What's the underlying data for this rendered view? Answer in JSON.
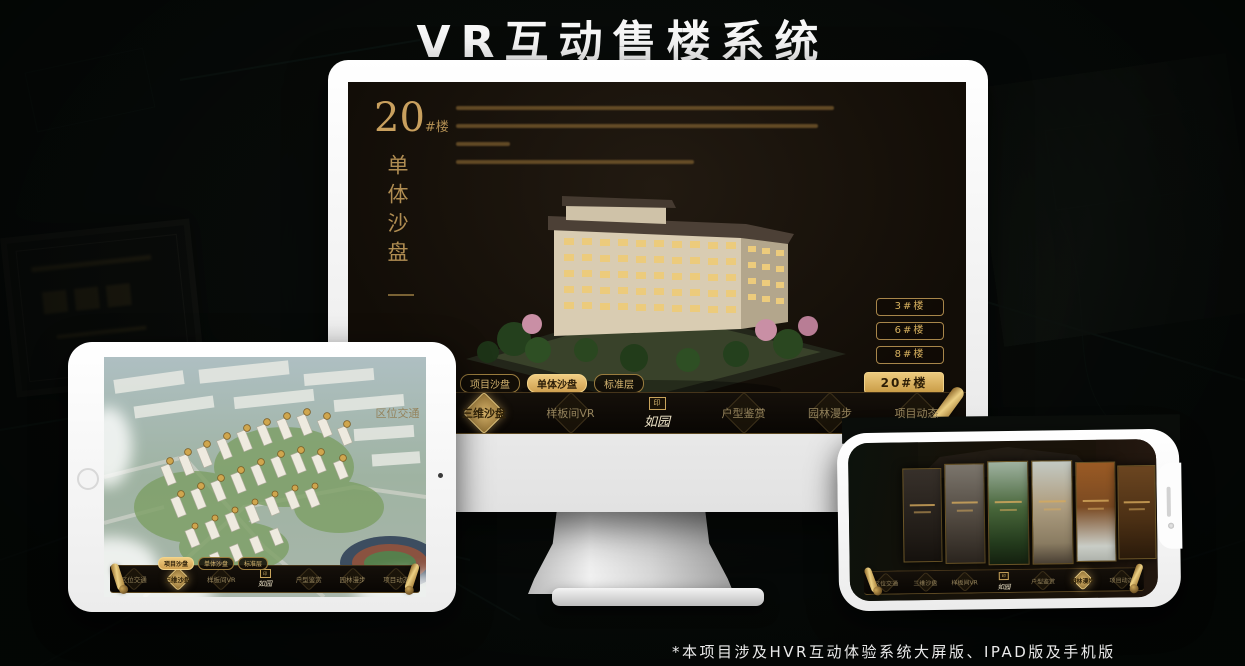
{
  "page": {
    "title": "VR互动售楼系统",
    "footnote": "*本项目涉及HVR互动体验系统大屏版、IPAD版及手机版"
  },
  "colors": {
    "gold": "#c9a05e",
    "gold_bright": "#ecca7e",
    "screen_bg": "#17110b",
    "title_white": "#f7f7f7"
  },
  "app": {
    "logo": "如园",
    "logo_seal": "印",
    "nav_items": [
      {
        "label": "区位交通"
      },
      {
        "label": "三维沙盘"
      },
      {
        "label": "样板间VR"
      },
      {
        "label": "户型鉴赏"
      },
      {
        "label": "园林漫步"
      },
      {
        "label": "项目动态"
      }
    ],
    "sub_tabs": [
      {
        "label": "项目沙盘"
      },
      {
        "label": "单体沙盘"
      },
      {
        "label": "标准层"
      }
    ]
  },
  "monitor": {
    "block_number": "20",
    "block_unit": "#楼",
    "block_subtitle": "单体沙盘",
    "active_sub_tab": "单体沙盘",
    "active_nav": "三维沙盘",
    "floor_buttons": [
      {
        "label": "3#楼"
      },
      {
        "label": "6#楼"
      },
      {
        "label": "8#楼"
      },
      {
        "label": "20#楼",
        "active": true
      }
    ]
  },
  "tablet": {
    "active_sub_tab": "项目沙盘",
    "active_nav": "三维沙盘"
  },
  "phone": {
    "active_nav": "园林漫步"
  }
}
